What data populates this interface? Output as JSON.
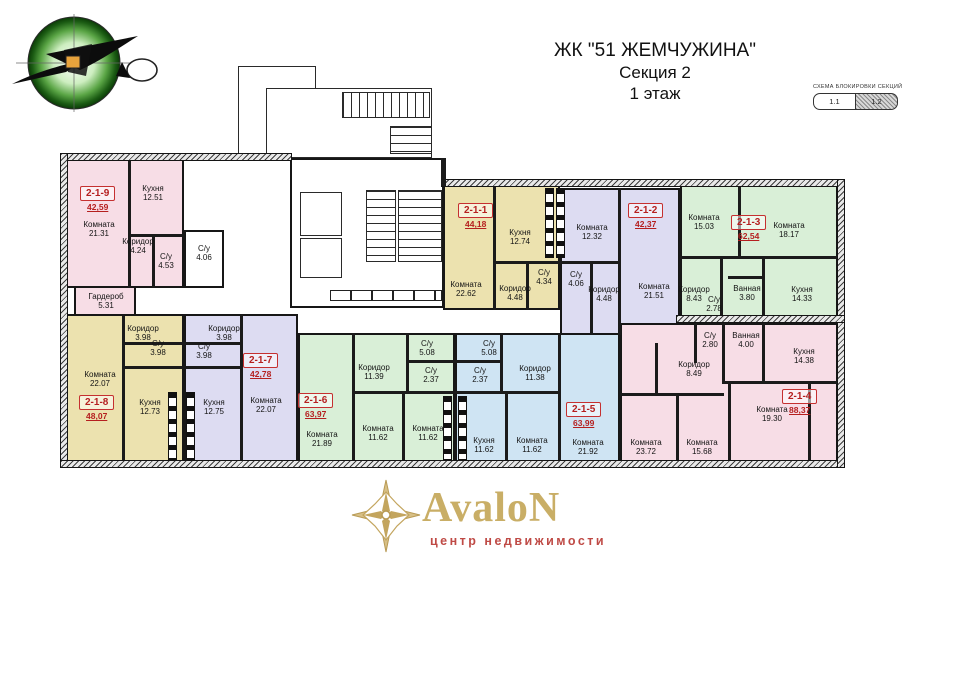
{
  "header": {
    "line1": "ЖК \"51 ЖЕМЧУЖИНА\"",
    "line2": "Секция 2",
    "line3": "1 этаж"
  },
  "section_schema": {
    "title": "СХЕМА БЛОКИРОВКИ СЕКЦИЙ",
    "blocks": [
      {
        "label": "1.1",
        "hatched": false
      },
      {
        "label": "1.2",
        "hatched": true
      }
    ]
  },
  "footer_logo": {
    "name": "AvaloN",
    "subtitle": "центр недвижимости"
  },
  "colors": {
    "pink": "#f7dde6",
    "yellow": "#ece2af",
    "lavender": "#dddcf2",
    "green": "#d9efd7",
    "blue": "#cfe4f3",
    "unit_accent": "#b51f1f",
    "wall": "#1b1b1b"
  },
  "common_areas": {
    "wc": {
      "name": "С/у",
      "area": "4.06"
    }
  },
  "apartments": [
    {
      "id": "2-1-9",
      "total": "42,59",
      "color": "pink",
      "rooms": [
        {
          "name": "Комната",
          "area": "21.31"
        },
        {
          "name": "Кухня",
          "area": "12.51"
        },
        {
          "name": "Коридор",
          "area": "4.24"
        },
        {
          "name": "С/у",
          "area": "4.53"
        }
      ]
    },
    {
      "id": "2-1-8",
      "total": "48,07",
      "color": "yellow",
      "rooms": [
        {
          "name": "Гардероб",
          "area": "5.31"
        },
        {
          "name": "Комната",
          "area": "22.07"
        },
        {
          "name": "Коридор",
          "area": "3.98"
        },
        {
          "name": "С/у",
          "area": "3.98"
        },
        {
          "name": "Кухня",
          "area": "12.73"
        }
      ]
    },
    {
      "id": "2-1-7",
      "total": "42,78",
      "color": "lavender",
      "rooms": [
        {
          "name": "Коридор",
          "area": "3.98"
        },
        {
          "name": "С/у",
          "area": "3.98"
        },
        {
          "name": "Кухня",
          "area": "12.75"
        },
        {
          "name": "Комната",
          "area": "22.07"
        }
      ]
    },
    {
      "id": "2-1-6",
      "total": "63,97",
      "color": "green",
      "rooms": [
        {
          "name": "Комната",
          "area": "21.89"
        },
        {
          "name": "Коридор",
          "area": "11.39"
        },
        {
          "name": "С/у",
          "area": "5.08"
        },
        {
          "name": "С/у",
          "area": "2.37"
        },
        {
          "name": "Комната",
          "area": "11.62"
        },
        {
          "name": "Комната",
          "area": "11.62"
        }
      ]
    },
    {
      "id": "2-1-5",
      "total": "63,99",
      "color": "blue",
      "rooms": [
        {
          "name": "Коридор",
          "area": "11.38"
        },
        {
          "name": "С/у",
          "area": "5.08"
        },
        {
          "name": "С/у",
          "area": "2.37"
        },
        {
          "name": "Кухня",
          "area": "11.62"
        },
        {
          "name": "Комната",
          "area": "11.62"
        },
        {
          "name": "Комната",
          "area": "21.92"
        }
      ]
    },
    {
      "id": "2-1-1",
      "total": "44,18",
      "color": "yellow",
      "rooms": [
        {
          "name": "Комната",
          "area": "22.62"
        },
        {
          "name": "Кухня",
          "area": "12.74"
        },
        {
          "name": "Коридор",
          "area": "4.48"
        },
        {
          "name": "С/у",
          "area": "4.34"
        }
      ]
    },
    {
      "id": "2-1-2",
      "total": "42,37",
      "color": "lavender",
      "rooms": [
        {
          "name": "Комната",
          "area": "12.32"
        },
        {
          "name": "Комната",
          "area": "21.51"
        },
        {
          "name": "Коридор",
          "area": "4.48"
        },
        {
          "name": "С/у",
          "area": "4.06"
        }
      ]
    },
    {
      "id": "2-1-3",
      "total": "62,54",
      "color": "green",
      "rooms": [
        {
          "name": "Комната",
          "area": "15.03"
        },
        {
          "name": "Комната",
          "area": "18.17"
        },
        {
          "name": "Коридор",
          "area": "8.43"
        },
        {
          "name": "С/у",
          "area": "2.78"
        },
        {
          "name": "Ванная",
          "area": "3.80"
        },
        {
          "name": "Кухня",
          "area": "14.33"
        }
      ]
    },
    {
      "id": "2-1-4",
      "total": "88,37",
      "color": "pink",
      "rooms": [
        {
          "name": "Коридор",
          "area": "8.49"
        },
        {
          "name": "С/у",
          "area": "2.80"
        },
        {
          "name": "Ванная",
          "area": "4.00"
        },
        {
          "name": "Кухня",
          "area": "14.38"
        },
        {
          "name": "Комната",
          "area": "19.30"
        },
        {
          "name": "Комната",
          "area": "23.72"
        },
        {
          "name": "Комната",
          "area": "15.68"
        }
      ]
    }
  ]
}
